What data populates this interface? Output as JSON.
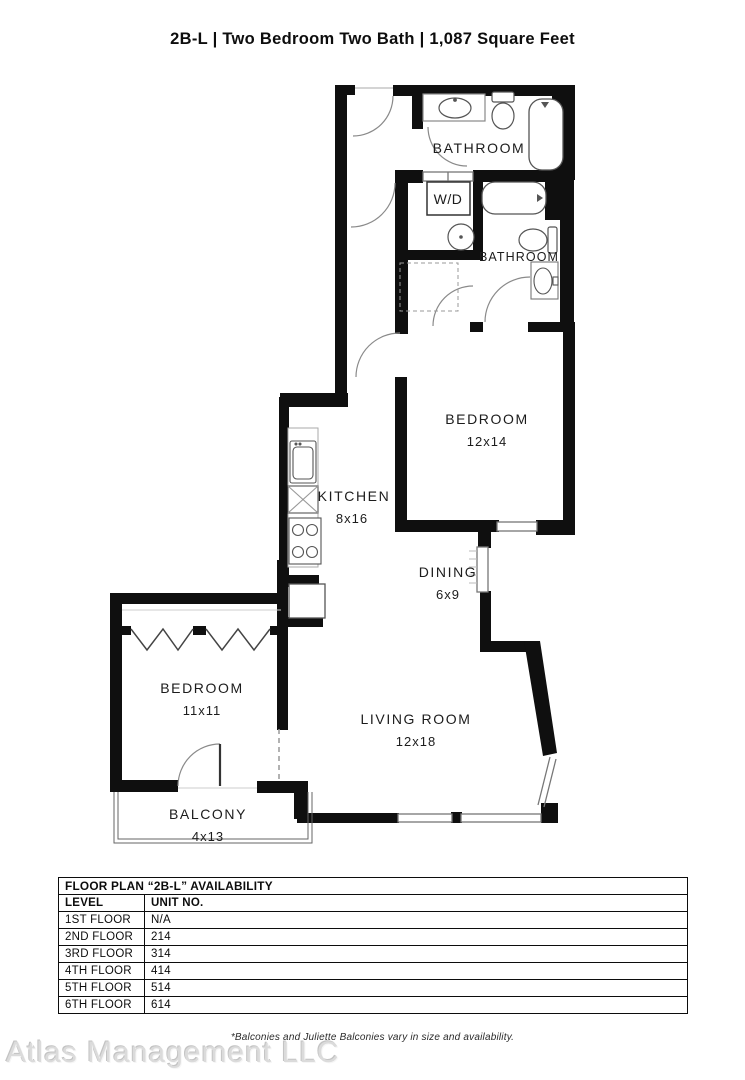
{
  "title": "2B-L | Two Bedroom Two Bath | 1,087  Square Feet",
  "colors": {
    "walls": "#0f0f0f",
    "paper": "#ffffff",
    "watermark": "#dbdbdb"
  },
  "floor_plan": {
    "rooms": {
      "bathroom1": {
        "label": "BATHROOM"
      },
      "laundry": {
        "label": "W/D"
      },
      "bathroom2": {
        "label": "BATHROOM"
      },
      "bedroom1": {
        "label": "BEDROOM",
        "dims": "12x14"
      },
      "kitchen": {
        "label": "KITCHEN",
        "dims": "8x16"
      },
      "dining": {
        "label": "DINING",
        "dims": "6x9"
      },
      "bedroom2": {
        "label": "BEDROOM",
        "dims": "11x11"
      },
      "living_room": {
        "label": "LIVING ROOM",
        "dims": "12x18"
      },
      "balcony": {
        "label": "BALCONY",
        "dims": "4x13"
      }
    },
    "fixtures": [
      "sink-vanity",
      "toilet",
      "bathtub",
      "washer-dryer",
      "round-sink",
      "kitchen-sink",
      "dishwasher",
      "stove",
      "refrigerator",
      "closet-rod-hangers"
    ]
  },
  "availability_table": {
    "title": "FLOOR PLAN “2B-L” AVAILABILITY",
    "columns": [
      "LEVEL",
      "UNIT NO."
    ],
    "rows": [
      [
        "1ST FLOOR",
        "N/A"
      ],
      [
        "2ND FLOOR",
        "214"
      ],
      [
        "3RD FLOOR",
        "314"
      ],
      [
        "4TH FLOOR",
        "414"
      ],
      [
        "5TH FLOOR",
        "514"
      ],
      [
        "6TH FLOOR",
        "614"
      ]
    ]
  },
  "footnote": "*Balconies and Juliette Balconies vary in size and availability.",
  "watermark": "Atlas Management LLC"
}
